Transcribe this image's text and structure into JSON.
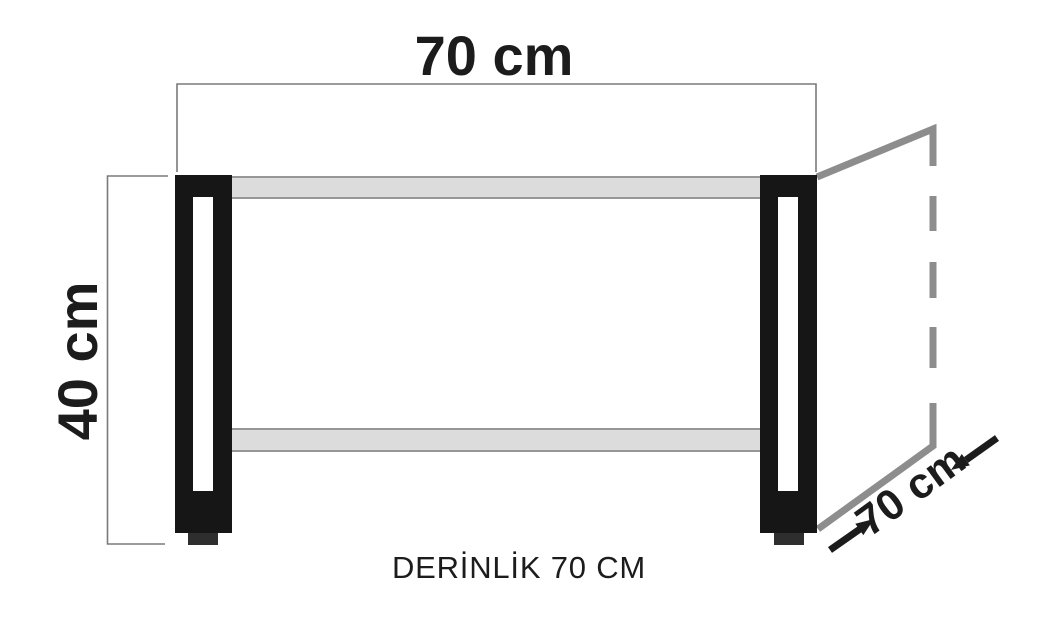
{
  "labels": {
    "width": "70 cm",
    "height": "40 cm",
    "depth": "70 cm",
    "caption": "DERİNLİK 70 CM"
  },
  "diagram": {
    "type": "furniture-dimension-drawing",
    "width_cm": 70,
    "height_cm": 40,
    "depth_cm": 70
  },
  "colors": {
    "background": "#ffffff",
    "leg": "#161616",
    "foot": "#2e2e2e",
    "shelf_fill": "#dcdcdc",
    "shelf_border": "#979797",
    "perspective_line": "#8d8d8d",
    "dimension_line": "#7a7a7a",
    "text": "#1c1c1c"
  }
}
